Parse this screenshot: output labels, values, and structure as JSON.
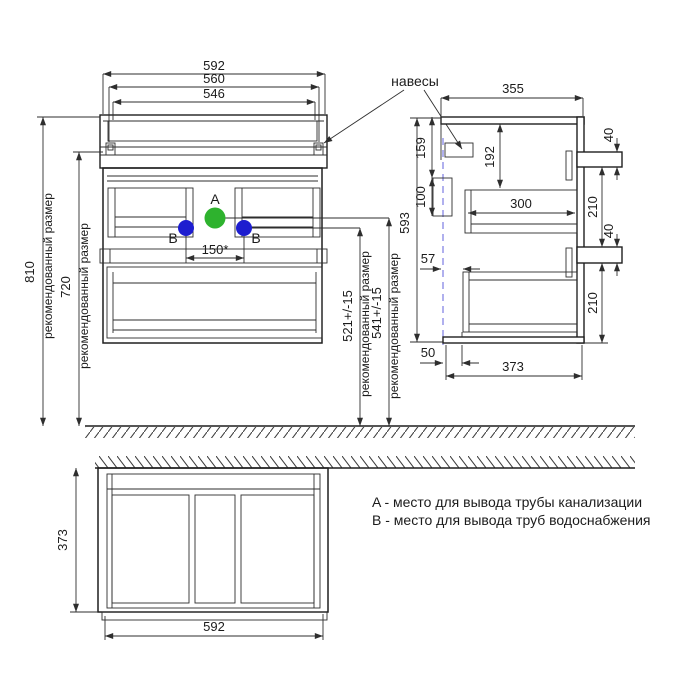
{
  "front": {
    "w592": "592",
    "w560": "560",
    "w546": "546",
    "h810": "810",
    "h720": "720",
    "rec": "рекомендованный размер",
    "b_height": "521+/-15",
    "a_height": "541+/-15",
    "spacing": "150*",
    "a": "A",
    "b": "B"
  },
  "side": {
    "d355": "355",
    "d159": "159",
    "d100": "100",
    "d593": "593",
    "d192": "192",
    "d300": "300",
    "d40": "40",
    "d210": "210",
    "d57": "57",
    "d50": "50",
    "d373": "373"
  },
  "bottom": {
    "d373": "373",
    "d592": "592"
  },
  "labels": {
    "hangers": "навесы"
  },
  "legend": {
    "a": "A - место для вывода трубы канализации",
    "b": "B - место для вывода труб водоснабжения"
  },
  "colors": {
    "pipe_a": "#2eb22e",
    "pipe_b": "#1d1dcf",
    "line": "#1f1f1f"
  }
}
